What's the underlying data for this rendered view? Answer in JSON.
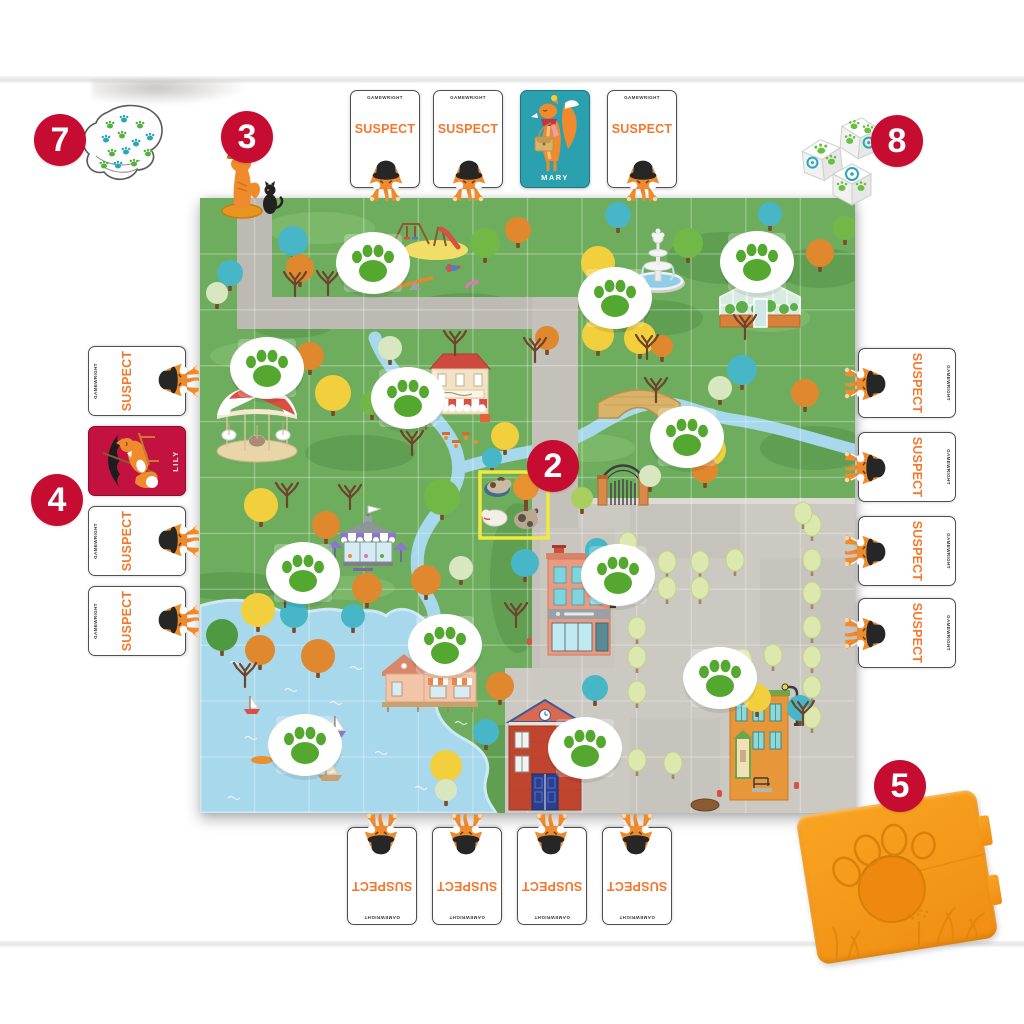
{
  "labels": {
    "suspect": "SUSPECT",
    "brand": "GAMEWRIGHT"
  },
  "steps": {
    "s2": "2",
    "s3": "3",
    "s4": "4",
    "s5": "5",
    "s7": "7",
    "s8": "8"
  },
  "revealed_cards": {
    "mary": {
      "name": "MARY",
      "bg": "#2ba1b0"
    },
    "lily": {
      "name": "LILY",
      "bg": "#c31240"
    }
  },
  "colors": {
    "step_circle": "#c60c30",
    "suspect_text": "#f4772e",
    "board_green": "#6fad5e",
    "path_gray": "#bdb9b3",
    "city_gray": "#ccc8c2",
    "water_blue": "#a8d8ec",
    "paw_green": "#55a82f",
    "token_teal": "#2aa7b8",
    "tray_orange": "#f79b1b",
    "highlight_yellow": "#f2e93e"
  },
  "cards": {
    "suspect_backs": [
      [
        385,
        139,
        0
      ],
      [
        468,
        139,
        0
      ],
      [
        642,
        139,
        0
      ],
      [
        907,
        383,
        90
      ],
      [
        907,
        467,
        90
      ],
      [
        907,
        551,
        90
      ],
      [
        907,
        633,
        90
      ],
      [
        137,
        381,
        -90
      ],
      [
        137,
        541,
        -90
      ],
      [
        137,
        621,
        -90
      ],
      [
        382,
        876,
        180
      ],
      [
        467,
        876,
        180
      ],
      [
        552,
        876,
        180
      ],
      [
        637,
        876,
        180
      ]
    ],
    "mary_pos": [
      555,
      139
    ],
    "lily_pos": [
      137,
      461
    ]
  },
  "board": {
    "paw_spots": [
      [
        173,
        65
      ],
      [
        415,
        100
      ],
      [
        557,
        64
      ],
      [
        67,
        170
      ],
      [
        208,
        200
      ],
      [
        487,
        239
      ],
      [
        103,
        375
      ],
      [
        245,
        447
      ],
      [
        105,
        547
      ],
      [
        418,
        377
      ],
      [
        520,
        480
      ],
      [
        385,
        550
      ]
    ],
    "trees": [
      [
        30,
        75,
        13,
        "teal"
      ],
      [
        93,
        43,
        15,
        "teal"
      ],
      [
        100,
        70,
        14,
        "or"
      ],
      [
        17,
        95,
        11,
        "pale"
      ],
      [
        285,
        45,
        15,
        "gr"
      ],
      [
        318,
        32,
        13,
        "or"
      ],
      [
        418,
        17,
        13,
        "teal"
      ],
      [
        398,
        65,
        17,
        "yl"
      ],
      [
        488,
        45,
        15,
        "gr"
      ],
      [
        570,
        16,
        12,
        "teal"
      ],
      [
        620,
        55,
        14,
        "or"
      ],
      [
        645,
        30,
        12,
        "gr"
      ],
      [
        440,
        140,
        16,
        "yl"
      ],
      [
        462,
        148,
        11,
        "or"
      ],
      [
        398,
        137,
        16,
        "yl"
      ],
      [
        347,
        140,
        12,
        "or"
      ],
      [
        542,
        172,
        15,
        "teal"
      ],
      [
        605,
        195,
        14,
        "or"
      ],
      [
        520,
        190,
        12,
        "pale"
      ],
      [
        110,
        158,
        14,
        "or"
      ],
      [
        133,
        195,
        18,
        "yl"
      ],
      [
        190,
        150,
        12,
        "pale"
      ],
      [
        172,
        205,
        12,
        "gr"
      ],
      [
        305,
        238,
        14,
        "yl"
      ],
      [
        292,
        260,
        10,
        "teal"
      ],
      [
        61,
        307,
        17,
        "yl"
      ],
      [
        126,
        327,
        14,
        "or"
      ],
      [
        242,
        299,
        18,
        "gr"
      ],
      [
        226,
        382,
        15,
        "or"
      ],
      [
        261,
        370,
        12,
        "pale"
      ],
      [
        58,
        412,
        17,
        "yl"
      ],
      [
        22,
        437,
        16,
        "dg"
      ],
      [
        60,
        452,
        15,
        "or"
      ],
      [
        94,
        416,
        14,
        "teal"
      ],
      [
        118,
        458,
        17,
        "or"
      ],
      [
        153,
        418,
        12,
        "teal"
      ],
      [
        167,
        390,
        15,
        "or"
      ],
      [
        300,
        488,
        14,
        "or"
      ],
      [
        286,
        534,
        13,
        "teal"
      ],
      [
        246,
        568,
        16,
        "yl"
      ],
      [
        246,
        592,
        11,
        "pale"
      ],
      [
        510,
        252,
        16,
        "yl"
      ],
      [
        505,
        272,
        13,
        "or"
      ],
      [
        450,
        278,
        11,
        "pale"
      ],
      [
        382,
        300,
        11,
        "lg"
      ],
      [
        325,
        365,
        14,
        "teal"
      ],
      [
        397,
        352,
        12,
        "teal"
      ],
      [
        395,
        490,
        13,
        "teal"
      ],
      [
        557,
        500,
        14,
        "yl"
      ],
      [
        600,
        510,
        13,
        "teal"
      ]
    ],
    "city_trees": [
      [
        437,
        364
      ],
      [
        467,
        364
      ],
      [
        500,
        364
      ],
      [
        535,
        362
      ],
      [
        467,
        390
      ],
      [
        500,
        390
      ],
      [
        612,
        327
      ],
      [
        612,
        362
      ],
      [
        612,
        395
      ],
      [
        612,
        429
      ],
      [
        612,
        459
      ],
      [
        612,
        489
      ],
      [
        612,
        519
      ],
      [
        437,
        430
      ],
      [
        437,
        459
      ],
      [
        437,
        494
      ],
      [
        437,
        562
      ],
      [
        473,
        565
      ],
      [
        507,
        462
      ],
      [
        543,
        462
      ],
      [
        573,
        457
      ],
      [
        603,
        315
      ],
      [
        428,
        345
      ]
    ],
    "bare_trees": [
      [
        128,
        88
      ],
      [
        95,
        89
      ],
      [
        60,
        178
      ],
      [
        87,
        300
      ],
      [
        85,
        400
      ],
      [
        316,
        420
      ],
      [
        456,
        195
      ],
      [
        545,
        132
      ],
      [
        603,
        518
      ],
      [
        255,
        148
      ],
      [
        212,
        248
      ],
      [
        150,
        302
      ],
      [
        447,
        152
      ],
      [
        335,
        155
      ],
      [
        45,
        480
      ]
    ],
    "hills": [
      [
        120,
        30,
        55,
        16,
        "l"
      ],
      [
        265,
        112,
        55,
        17,
        "d"
      ],
      [
        55,
        158,
        45,
        14,
        "l"
      ],
      [
        525,
        60,
        58,
        26,
        "d"
      ],
      [
        620,
        70,
        45,
        20,
        "d"
      ],
      [
        455,
        120,
        48,
        18,
        "d"
      ],
      [
        160,
        255,
        55,
        18,
        "d"
      ],
      [
        615,
        250,
        55,
        22,
        "d"
      ],
      [
        30,
        388,
        55,
        14,
        "d"
      ],
      [
        150,
        390,
        45,
        12,
        "l"
      ],
      [
        318,
        380,
        28,
        75,
        "d"
      ],
      [
        302,
        572,
        32,
        45,
        "d"
      ],
      [
        92,
        128,
        40,
        12,
        "d"
      ],
      [
        390,
        250,
        45,
        14,
        "l"
      ],
      [
        570,
        120,
        40,
        14,
        "l"
      ]
    ],
    "waves": [
      [
        30,
        465
      ],
      [
        85,
        492
      ],
      [
        45,
        540
      ],
      [
        130,
        505
      ],
      [
        185,
        488
      ],
      [
        95,
        575
      ],
      [
        175,
        555
      ],
      [
        240,
        485
      ],
      [
        255,
        525
      ],
      [
        215,
        590
      ],
      [
        28,
        600
      ],
      [
        150,
        470
      ]
    ]
  },
  "token_pile": {
    "paws": [
      [
        32,
        26,
        "g"
      ],
      [
        46,
        20,
        "t"
      ],
      [
        62,
        26,
        "g"
      ],
      [
        72,
        38,
        "t"
      ],
      [
        28,
        40,
        "t"
      ],
      [
        44,
        36,
        "g"
      ],
      [
        58,
        44,
        "t"
      ],
      [
        70,
        54,
        "g"
      ],
      [
        34,
        54,
        "g"
      ],
      [
        48,
        52,
        "t"
      ],
      [
        40,
        66,
        "t"
      ],
      [
        56,
        64,
        "g"
      ],
      [
        26,
        66,
        "g"
      ]
    ]
  }
}
